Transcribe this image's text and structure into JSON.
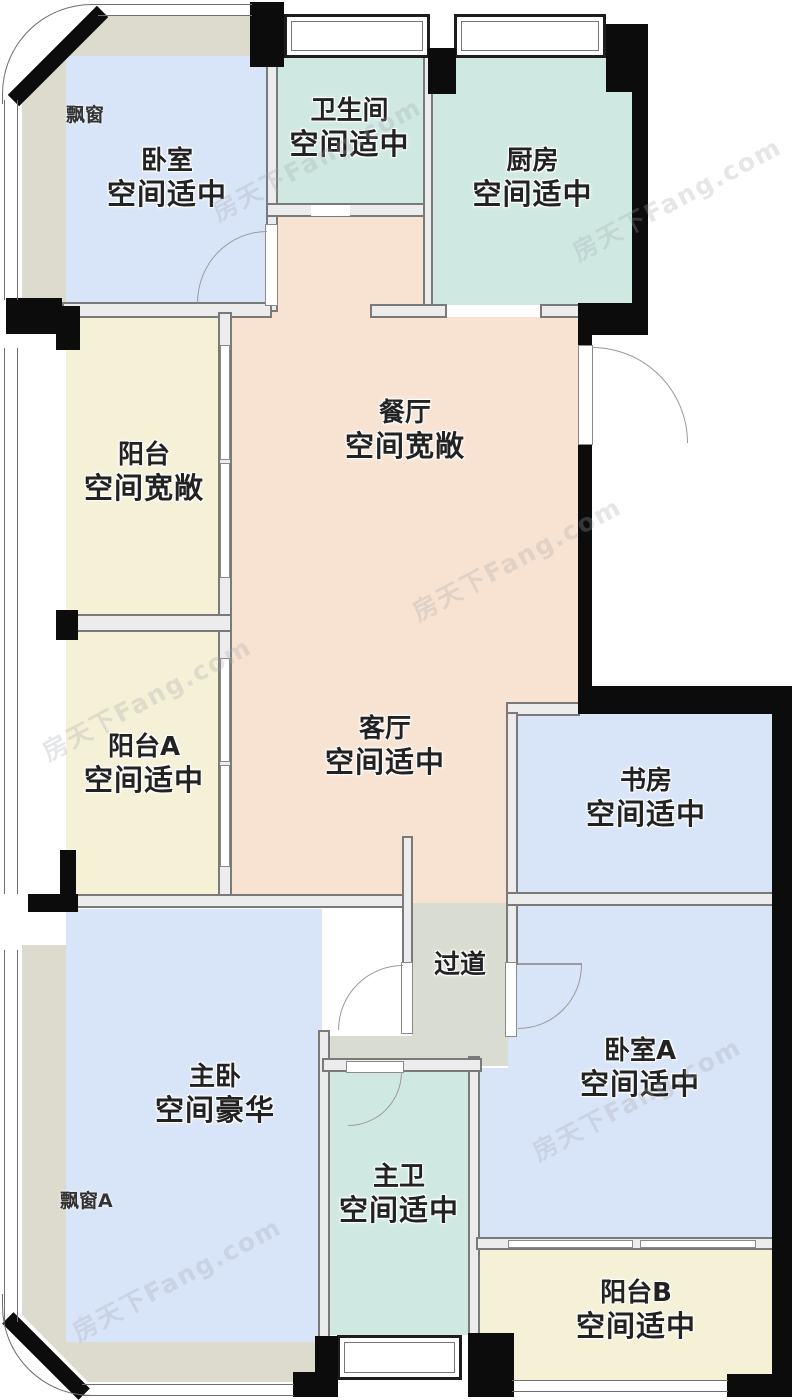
{
  "watermark": "房天下Fang.com",
  "annotations": {
    "bay_window": "飘窗",
    "bay_window_a": "飘窗A"
  },
  "rooms": [
    {
      "id": "bedroom",
      "name": "卧室",
      "desc": "空间适中"
    },
    {
      "id": "bathroom",
      "name": "卫生间",
      "desc": "空间适中"
    },
    {
      "id": "kitchen",
      "name": "厨房",
      "desc": "空间适中"
    },
    {
      "id": "dining",
      "name": "餐厅",
      "desc": "空间宽敞"
    },
    {
      "id": "balcony",
      "name": "阳台",
      "desc": "空间宽敞"
    },
    {
      "id": "balcony-a",
      "name": "阳台A",
      "desc": "空间适中"
    },
    {
      "id": "living",
      "name": "客厅",
      "desc": "空间适中"
    },
    {
      "id": "study",
      "name": "书房",
      "desc": "空间适中"
    },
    {
      "id": "hallway",
      "name": "过道",
      "desc": ""
    },
    {
      "id": "master",
      "name": "主卧",
      "desc": "空间豪华"
    },
    {
      "id": "bedroom-a",
      "name": "卧室A",
      "desc": "空间适中"
    },
    {
      "id": "master-bath",
      "name": "主卫",
      "desc": "空间适中"
    },
    {
      "id": "balcony-b",
      "name": "阳台B",
      "desc": "空间适中"
    }
  ],
  "colors": {
    "bedroom_fill": "#d8e5f8",
    "wet_room_fill": "#cfe9e2",
    "living_dining_fill": "#f8e3d2",
    "balcony_fill": "#f4f1d6",
    "bay_window_fill": "#dcdbcd",
    "hallway_fill": "#d9ddd1",
    "exterior_wall": "#0c0c0c",
    "interior_wall": "#7a7a7a"
  }
}
